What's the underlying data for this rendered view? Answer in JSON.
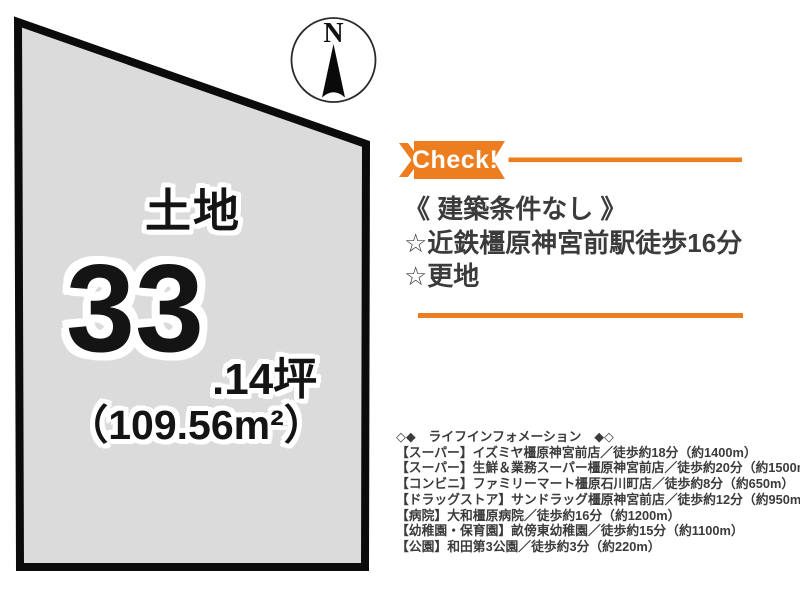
{
  "colors": {
    "accent_orange": "#ED7E1F",
    "land_fill": "#DBDBDB",
    "land_border": "#0B0B0B",
    "text_dark": "#3B3B3B"
  },
  "compass": {
    "label": "N"
  },
  "land": {
    "title": "土地",
    "area_tsubo_main": "33",
    "area_tsubo_suffix": ".14坪",
    "area_sqm": "（109.56m²）"
  },
  "check_banner": {
    "label": "Check!"
  },
  "highlights": {
    "line1": "《 建築条件なし 》",
    "line2": "☆近鉄橿原神宮前駅徒歩16分",
    "line3": "☆更地"
  },
  "lifeinfo": {
    "header": "◇◆　ライフインフォメーション　◆◇",
    "items": [
      "【スーパー】イズミヤ橿原神宮前店／徒歩約18分（約1400m）",
      "【スーパー】生鮮＆業務スーパー橿原神宮前店／徒歩約20分（約1500m）",
      "【コンビニ】ファミリーマート橿原石川町店／徒歩約8分（約650m）",
      "【ドラッグストア】サンドラッグ橿原神宮前店／徒歩約12分（約950m）",
      "【病院】大和橿原病院／徒歩約16分（約1200m）",
      "【幼稚園・保育園】畝傍東幼稚園／徒歩約15分（約1100m）",
      "【公園】和田第3公園／徒歩約3分（約220m）"
    ]
  }
}
